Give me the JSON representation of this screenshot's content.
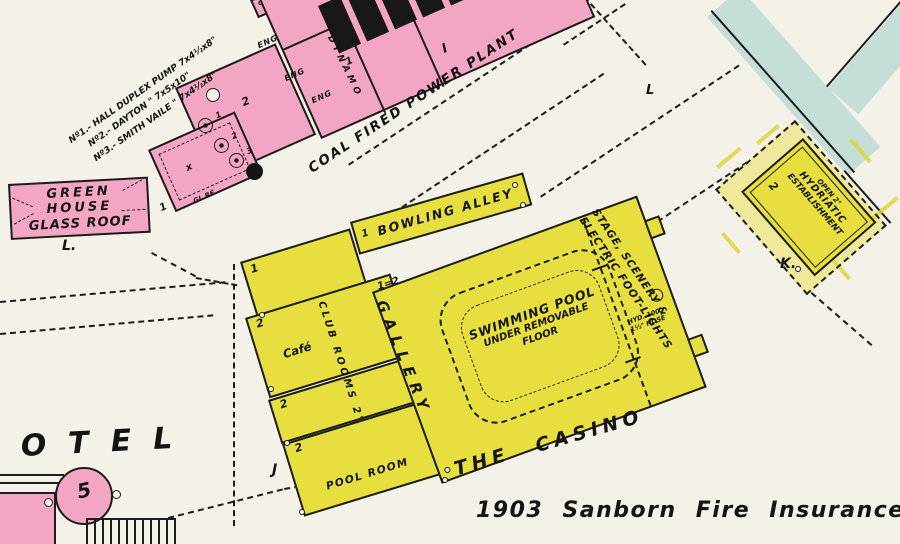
{
  "caption": "1903 Sanborn Fire Insurance Map",
  "streets": {
    "power_plant_road": "COAL FIRED POWER PLANT",
    "road_mark": "L"
  },
  "power_plant": {
    "pump_notes": [
      "Nº1.- HALL DUPLEX PUMP 7x4½x8\"",
      "Nº2.- DAYTON   \"   7x5x10\"",
      "Nº3.- SMITH VAILE \"  7x4½x8\""
    ],
    "oil": "OIL",
    "eng": [
      "ENG",
      "ENG",
      "ENG"
    ],
    "dynamo": "DYNAMO",
    "dynamo_story": "2",
    "pump_nums": [
      "1",
      "2",
      "3"
    ],
    "glass_roof": "GL RF",
    "x_mark": "x",
    "tick1": "1",
    "tick2": "I",
    "tick3": "1"
  },
  "greenhouse": {
    "lines": [
      "GREEN",
      "HOUSE",
      "GLASS ROOF"
    ],
    "block_mark": "L."
  },
  "casino": {
    "name": "THE CASINO",
    "bowling_alley": "BOWLING ALLEY",
    "bowling_story": "1",
    "gallery": "GALLERY",
    "pool_lines": [
      "SWIMMING POOL",
      "UNDER REMOVABLE",
      "FLOOR"
    ],
    "stage_lines": [
      "STAGE, SCENERY &",
      "ELECTRIC FOOT-LIGHTS"
    ],
    "hyd_lines": [
      "HYD. 100'",
      "1½\" HOSE"
    ],
    "club_rooms": "CLUB ROOMS 2°",
    "cafe": "Café",
    "pool_room": "POOL ROOM",
    "wing_story": "1",
    "club_story": "2",
    "club2_story": "2",
    "poolroom_story": "2",
    "junction_mark": "1=2",
    "block_mark": "J"
  },
  "hydriatic": {
    "open": "OPEN 2°",
    "lines": [
      "HYDRIATIC",
      "ESTABLISHMENT"
    ],
    "story": "2",
    "block_mark": "K."
  },
  "hotel": {
    "name_partial": "OTEL",
    "tower_number": "5"
  }
}
